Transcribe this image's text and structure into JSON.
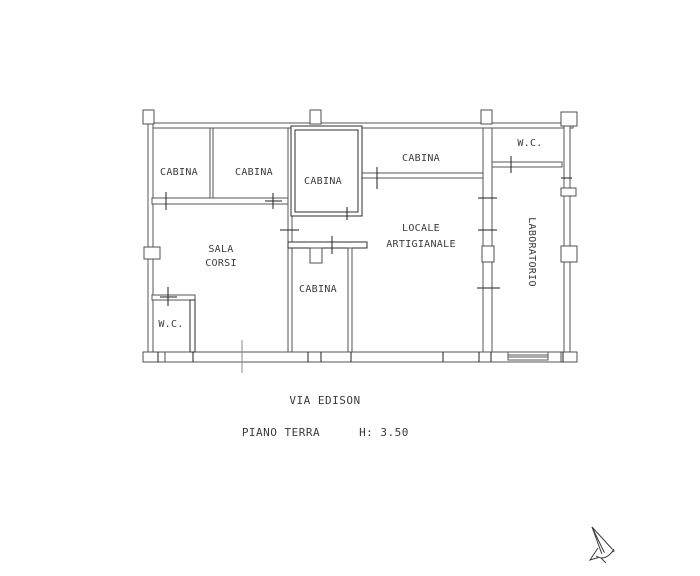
{
  "colors": {
    "background": "#ffffff",
    "wall": "#565656",
    "wall_dark": "#2e2e2e",
    "tick": "#1f1f1f",
    "text": "#3b3b3b"
  },
  "rooms": [
    {
      "id": "cabina-top-left",
      "label": "CABINA"
    },
    {
      "id": "cabina-top-mid-left",
      "label": "CABINA"
    },
    {
      "id": "cabina-top-center",
      "label": "CABINA"
    },
    {
      "id": "cabina-top-right",
      "label": "CABINA"
    },
    {
      "id": "wc-upper-right",
      "label": "W.C."
    },
    {
      "id": "sala-corsi",
      "line1": "SALA",
      "line2": "CORSI"
    },
    {
      "id": "locale-artigianale",
      "line1": "LOCALE",
      "line2": "ARTIGIANALE"
    },
    {
      "id": "cabina-lower-mid",
      "label": "CABINA"
    },
    {
      "id": "wc-lower-left",
      "label": "W.C."
    },
    {
      "id": "laboratorio",
      "label": "LABORATORIO"
    }
  ],
  "annotations": {
    "street": "VIA EDISON",
    "floor": "PIANO TERRA",
    "height": "H: 3.50"
  },
  "icons": {
    "north_arrow": "north-arrow-icon"
  }
}
